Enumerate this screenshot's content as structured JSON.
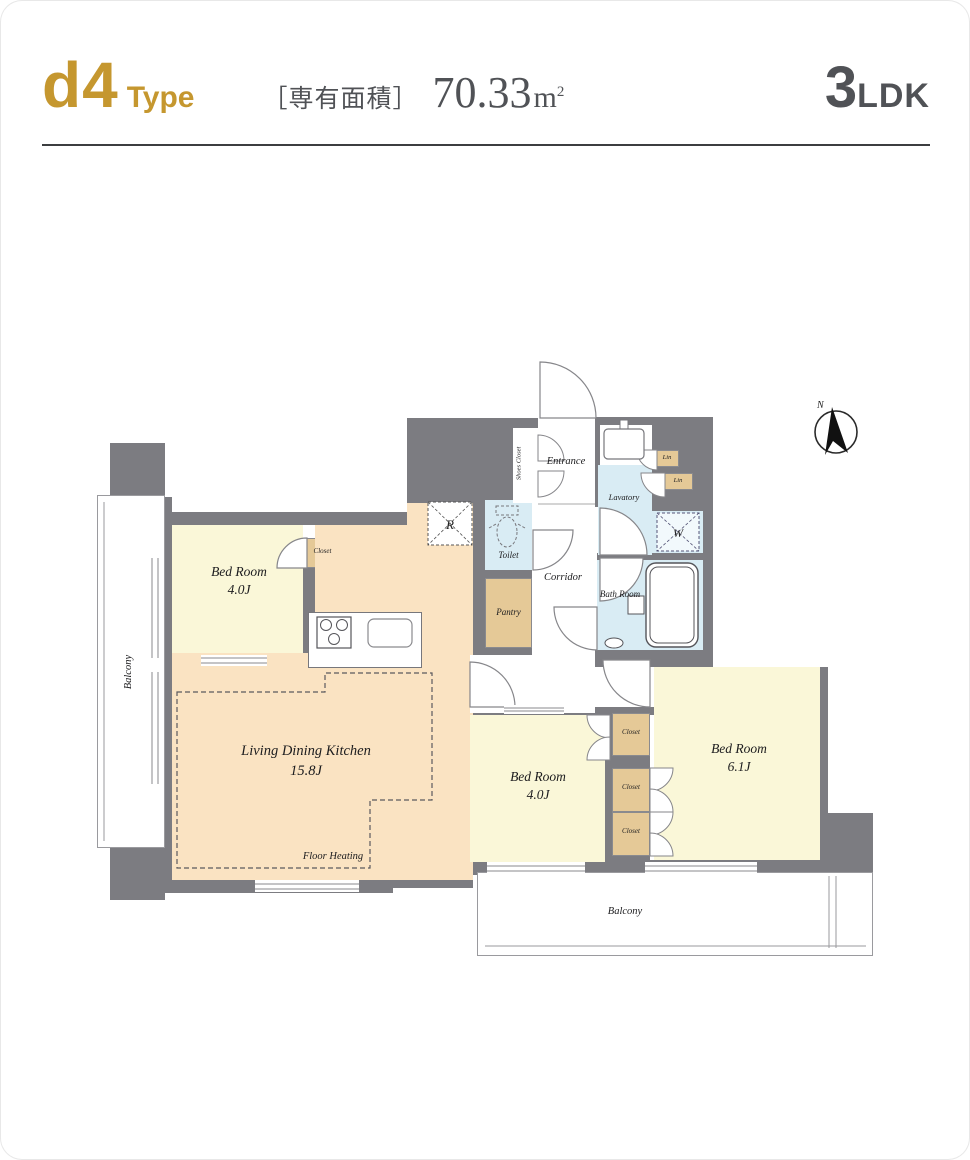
{
  "header": {
    "type_code": "d4",
    "type_word": "Type",
    "area_bracket_label": "［専有面積］",
    "area_value": "70.33",
    "area_unit_base": "m",
    "area_unit_sup": "2",
    "layout_number": "3",
    "layout_letters": "LDK",
    "accent_color": "#c5972f",
    "text_color": "#505256"
  },
  "plan": {
    "compass_label": "N",
    "rooms": {
      "bedroom_left_name": "Bed Room",
      "bedroom_left_size": "4.0J",
      "ldk_name": "Living Dining Kitchen",
      "ldk_size": "15.8J",
      "ldk_note": "Floor Heating",
      "bedroom_center_name": "Bed Room",
      "bedroom_center_size": "4.0J",
      "bedroom_right_name": "Bed Room",
      "bedroom_right_size": "6.1J",
      "entrance": "Entrance",
      "shoes_closet": "Shoes Closet",
      "lavatory": "Lavatory",
      "toilet": "Toilet",
      "bath": "Bath Room",
      "corridor": "Corridor",
      "pantry": "Pantry",
      "closet": "Closet",
      "lin": "Lin",
      "balcony": "Balcony",
      "refrigerator_symbol": "R",
      "washer_symbol": "W"
    },
    "colors": {
      "wall": "#7c7c81",
      "room_yellow": "#faf7d8",
      "room_peach": "#fae3c2",
      "room_blue": "#d9ecf4",
      "closet_tan": "#e5c997"
    }
  }
}
